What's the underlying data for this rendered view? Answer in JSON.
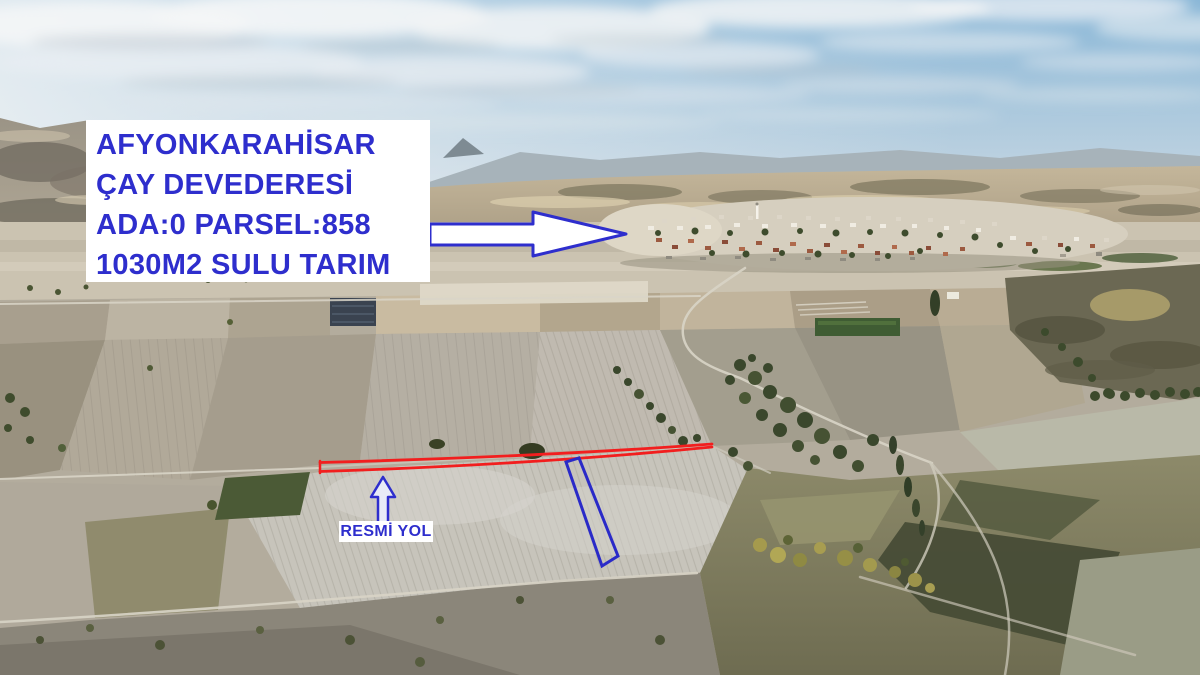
{
  "overlay": {
    "info_box": {
      "lines": [
        "AFYONKARAHİSAR",
        "ÇAY DEVEDERESİ",
        "ADA:0 PARSEL:858",
        "1030M2 SULU TARIM"
      ]
    },
    "road_label": "RESMİ YOL",
    "icons": {
      "village_pointer": "right-arrow-icon",
      "road_pointer": "up-arrow-icon"
    },
    "colors": {
      "annotation_blue": "#2e2ecd",
      "parcel_outline_red": "#f21e1e",
      "parcel_outline_blue": "#2a2ac8",
      "label_background": "#ffffff"
    }
  }
}
